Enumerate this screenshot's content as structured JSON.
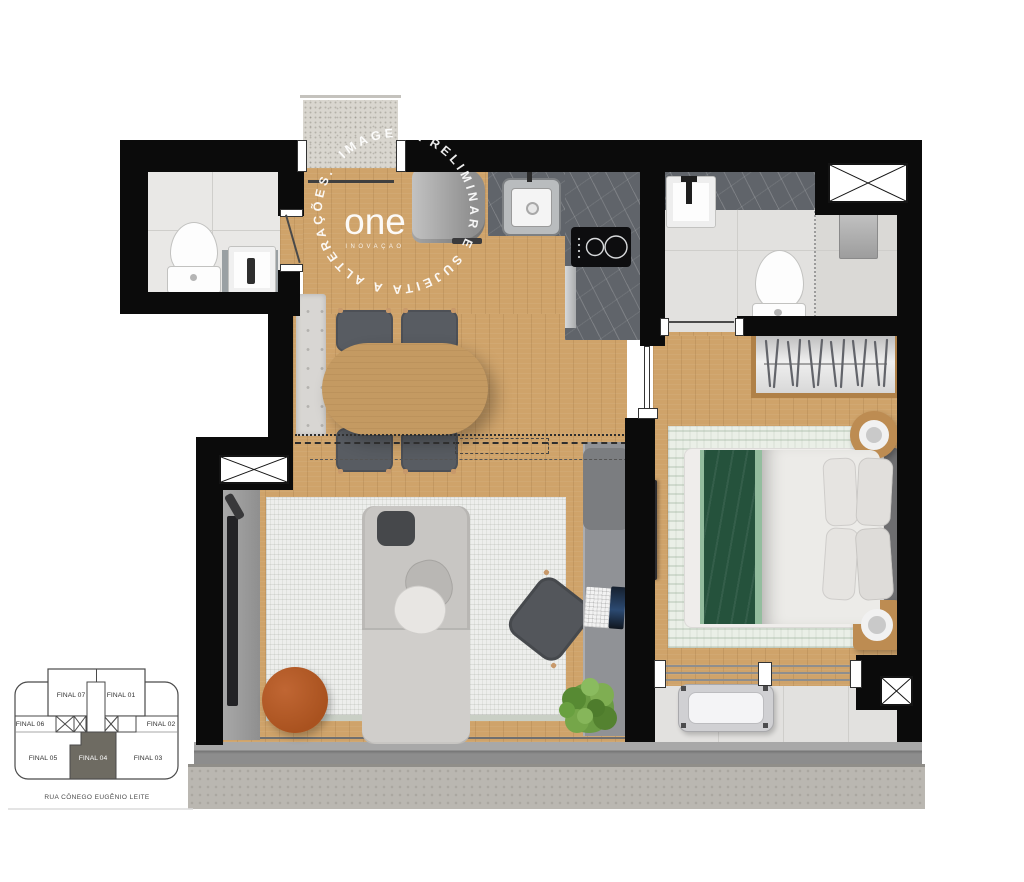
{
  "watermark": {
    "ring_text": "IMAGEM PRELIMINAR E SUJEITA A ALTERAÇÕES.",
    "logo_text": "one",
    "logo_tagline": "INOVAÇÃO"
  },
  "key_plan": {
    "units": [
      {
        "label": "FINAL 07",
        "highlighted": false
      },
      {
        "label": "FINAL 01",
        "highlighted": false
      },
      {
        "label": "FINAL 06",
        "highlighted": false
      },
      {
        "label": "FINAL 02",
        "highlighted": false
      },
      {
        "label": "FINAL 05",
        "highlighted": false
      },
      {
        "label": "FINAL 04",
        "highlighted": true
      },
      {
        "label": "FINAL 03",
        "highlighted": false
      }
    ],
    "highlighted_unit": "FINAL 04",
    "street": "RUA CÔNEGO EUGÊNIO LEITE"
  },
  "colors": {
    "wall": "#0b0b0b",
    "wood_floor": "#cfa36a",
    "bath_tile": "#e9e8e6",
    "counter_marble": "#60646a",
    "entry_granite": "#d9d6cf",
    "bed_blanket_green": "#25523c",
    "bed_blanket_green_light": "#93bd9e",
    "coffee_table_orange": "#b2592a",
    "living_rug": "#edeeec",
    "keyplan_highlight": "#6e6b62",
    "balcony_sill_gray": "#8d8d8d"
  }
}
